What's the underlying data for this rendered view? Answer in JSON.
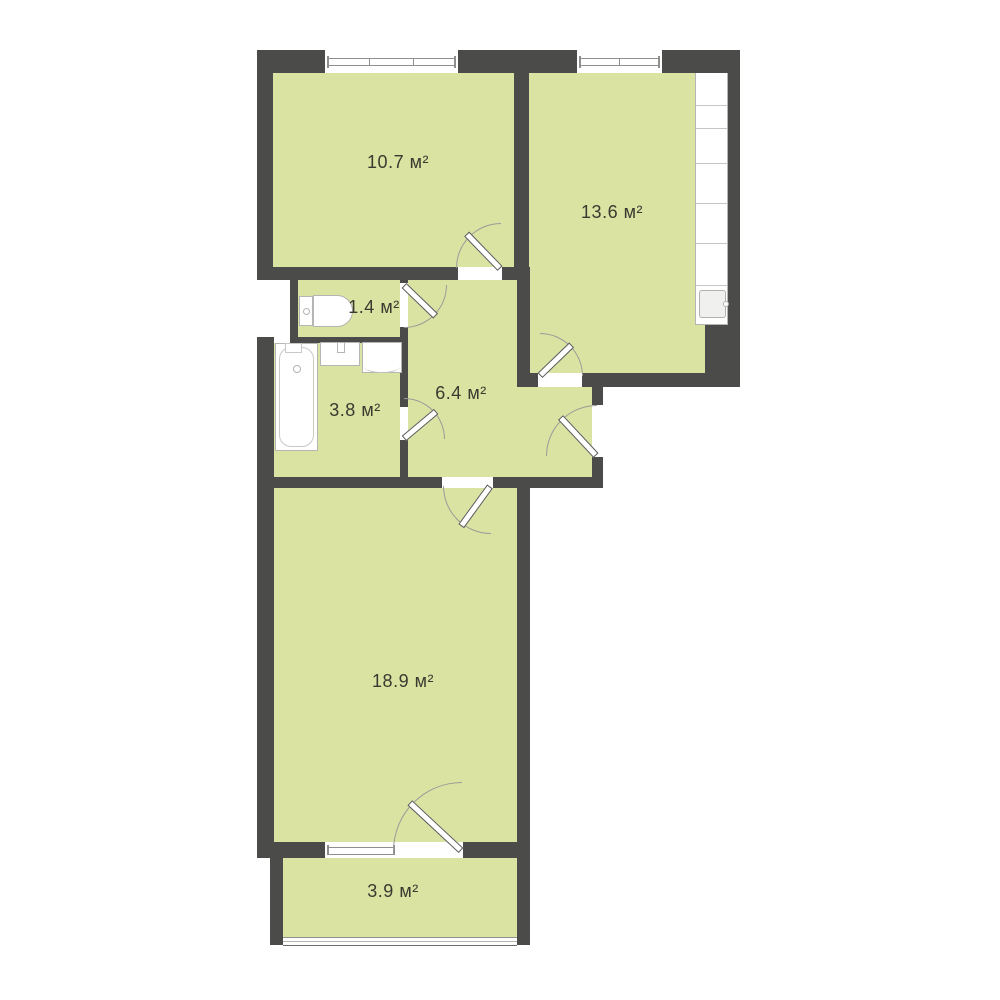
{
  "plan": {
    "title": "2-room apartment floor plan",
    "unit_suffix": "м²",
    "rooms": {
      "bedroom": {
        "label": "10.7 м²",
        "area": 10.7
      },
      "kitchen": {
        "label": "13.6 м²",
        "area": 13.6
      },
      "wc": {
        "label": "1.4 м²",
        "area": 1.4
      },
      "bathroom": {
        "label": "3.8 м²",
        "area": 3.8
      },
      "hallway": {
        "label": "6.4 м²",
        "area": 6.4
      },
      "living_room": {
        "label": "18.9 м²",
        "area": 18.9
      },
      "balcony": {
        "label": "3.9 м²",
        "area": 3.9
      }
    },
    "fixtures": [
      "toilet",
      "bathtub",
      "wash-basin",
      "washing-machine",
      "kitchen-counter",
      "kitchen-sink"
    ],
    "doors": [
      "bedroom-door",
      "wc-door",
      "bathroom-door",
      "kitchen-door",
      "entrance-door",
      "living-room-door",
      "balcony-door"
    ],
    "windows": [
      "bedroom-window",
      "kitchen-window",
      "living-room-window",
      "balcony-glazing"
    ]
  },
  "colors": {
    "bg": "#ffffff",
    "wall": "#4b4b49",
    "room": "#dae3a2",
    "label": "#3a3a31",
    "fixture": "#b5b5b3"
  }
}
